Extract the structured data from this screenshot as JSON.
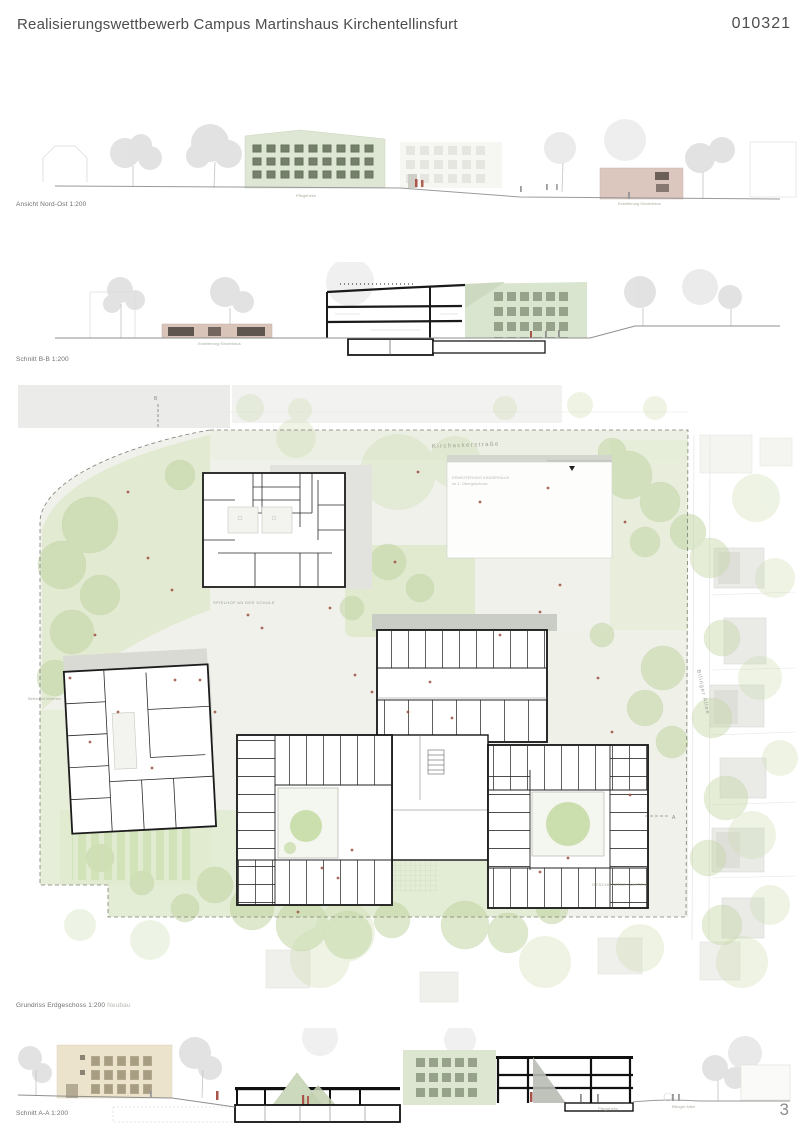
{
  "header": {
    "title": "Realisierungswettbewerb Campus Martinshaus Kirchentellinsfurt",
    "code": "010321"
  },
  "page_number": "3",
  "drawings": {
    "elevation_ne": {
      "caption": "Ansicht Nord-Ost 1:200",
      "labels": {
        "pflegeheim": "Pflegeheim",
        "erweiterung": "Erweiterung Kinderhaus"
      }
    },
    "section_bb": {
      "caption": "Schnitt B-B 1:200",
      "labels": {
        "low_building": "Erweiterung Kinderhaus"
      }
    },
    "site_plan": {
      "caption": "Grundriss Erdgeschoss 1:200",
      "caption_suffix": "Neubau",
      "labels": {
        "street_top": "Kirchackerstraße",
        "street_right": "Bilinger Allee",
        "bestand_line1": "ERWEITERUNG KINDERHAUS",
        "bestand_line2": "im 1. Obergeschoss",
        "school": "SPIELHOF AN DER SCHULE",
        "garden": "GESCHÜTZTER GARTEN",
        "wohnen": "Betreutes Wohnen",
        "marker_a": "A",
        "marker_b": "B"
      }
    },
    "section_aa": {
      "caption": "Schnitt A-A 1:200",
      "labels": {
        "pflegeheim": "Pflegeheim",
        "allee": "Bilinger Allee"
      }
    }
  },
  "colors": {
    "building_green": "#dde7d3",
    "building_pink": "#dcc7be",
    "building_cream": "#ece3cd",
    "wall_black": "#1a1a1a",
    "site_green": "#dfe9cb",
    "figure_red": "#a8544a"
  }
}
